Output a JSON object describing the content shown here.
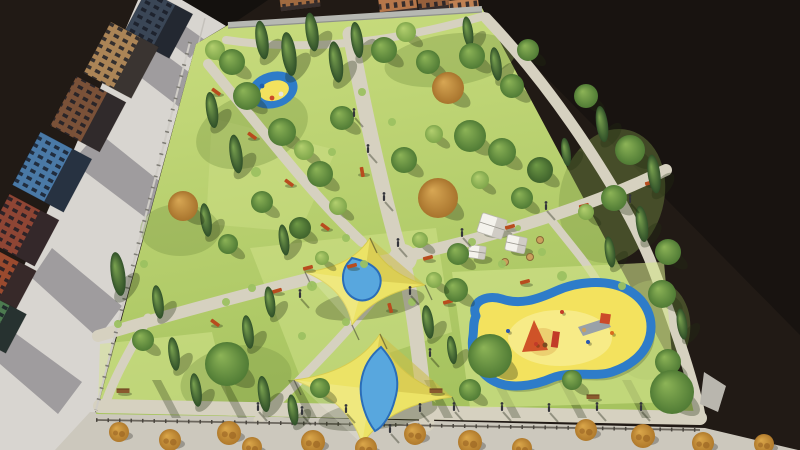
{
  "canvas": {
    "width": 800,
    "height": 450
  },
  "colors": {
    "bg": "#211a15",
    "bgDeep": "#181310",
    "street": "#d8d5d0",
    "sidewalk": "#ccc8bd",
    "curb": "#c4c1bb",
    "path": "#d6d1c0",
    "lawnTop": "#cadd7f",
    "lawnBottom": "#a6c35f",
    "lawnPatch": "#d6e690",
    "clusterShade": "#7f9c49",
    "wall": "#b6b8b2",
    "wallEdge": "#8f918c",
    "fenceLight": "#cfccc6",
    "fencePost": "#7d7b74",
    "fenceDark": "#6b665d",
    "fencePostDark": "#49453e",
    "buildingShadow": "#504e58",
    "roofDark": "#14110e",
    "windowTint": "rgba(22,26,36,0.8)",
    "sail": "#ece366",
    "sailEdge": "#d8cc4f",
    "pool": "#58a7de",
    "poolEdge": "#2a6db8",
    "playBlue": "#2e7cc9",
    "playYellow": "#f3e25e",
    "sand": "#f7ec8e",
    "pad": "#d3e48c",
    "tent": "#f4f2ec",
    "tentShade": "#c9c6be",
    "benchRed": "#b84c1e",
    "benchWood": "#8a5a2e",
    "shrubDot": "#a06a26",
    "person": "#33343a",
    "shadow": "rgba(35,48,18,0.32)",
    "stripe": "rgba(25,35,12,0.28)",
    "tree": {
      "d": [
        "#8db457",
        "#507b35"
      ],
      "k": [
        "#6f9a46",
        "#3f632c"
      ],
      "l": [
        "#b4d06f",
        "#7fa64b"
      ],
      "o": [
        "#d8a754",
        "#a8742d"
      ],
      "c": [
        "#7ba350",
        "#2f4f28"
      ],
      "s": [
        "#dba74a",
        "#b07a2c"
      ]
    },
    "bush": "#9cc161"
  },
  "scene": {
    "darkTriangle": "470,0 800,0 800,335",
    "street": "138,0 185,0 226,26 196,44 96,410 78,450 0,450 0,322",
    "sidewalk": "55,450 90,412 705,428 798,450",
    "curbLine": [
      205,
      18,
      110,
      392
    ],
    "darkWedge": "182,0 268,0 228,27",
    "streetShadows": [
      "160,8 205,40 190,58 143,22",
      "148,42 216,92 196,120 126,66",
      "98,132 168,188 146,218 72,162",
      "52,248 122,306 98,338 32,278",
      "0,322 82,382 58,414 0,364"
    ],
    "buildings": [
      {
        "cx": 158,
        "cy": 24,
        "w": 50,
        "h": 52,
        "a": -62,
        "f": "#3a4656"
      },
      {
        "cx": 121,
        "cy": 60,
        "w": 58,
        "h": 54,
        "a": -62,
        "f": "#ab8456"
      },
      {
        "cx": 88,
        "cy": 114,
        "w": 56,
        "h": 56,
        "a": -62,
        "f": "#7a5138"
      },
      {
        "cx": 52,
        "cy": 172,
        "w": 60,
        "h": 58,
        "a": -62,
        "f": "#4a79a6"
      },
      {
        "cx": 22,
        "cy": 230,
        "w": 52,
        "h": 56,
        "a": -62,
        "f": "#8e4534"
      },
      {
        "cx": 2,
        "cy": 280,
        "w": 48,
        "h": 52,
        "a": -62,
        "f": "#9a4a2e"
      },
      {
        "cx": -6,
        "cy": 322,
        "w": 44,
        "h": 50,
        "a": -62,
        "f": "#4d7a50"
      }
    ],
    "topBuildings": [
      {
        "cx": 300,
        "cy": 2,
        "w": 40,
        "h": 14,
        "a": -7,
        "f": "#a06a40"
      },
      {
        "cx": 398,
        "cy": 6,
        "w": 38,
        "h": 20,
        "a": -7,
        "f": "#b5764a"
      },
      {
        "cx": 434,
        "cy": 3,
        "w": 32,
        "h": 18,
        "a": -7,
        "f": "#96603c"
      },
      {
        "cx": 464,
        "cy": 7,
        "w": 30,
        "h": 16,
        "a": -7,
        "f": "#c08152"
      }
    ],
    "park": "196,44 230,24 482,8 704,424 96,414",
    "lawnPatches": [
      {
        "pts": "250,248 436,228 452,332 302,382",
        "o": 0.45
      },
      {
        "pts": "100,344 212,332 232,416 98,406",
        "o": 0.5
      },
      {
        "pts": "212,118 336,150 300,232 206,224",
        "o": 0.35
      }
    ],
    "clusterShades": [
      [
        252,
        130,
        58,
        36,
        -20
      ],
      [
        612,
        196,
        52,
        68,
        15
      ],
      [
        236,
        380,
        56,
        34,
        -10
      ],
      [
        450,
        60,
        66,
        26,
        -8
      ],
      [
        180,
        230,
        40,
        26,
        0
      ],
      [
        650,
        330,
        40,
        50,
        10
      ]
    ],
    "wallTop": [
      228,
      25,
      482,
      9
    ],
    "fenceLeft": [
      190,
      42,
      96,
      410
    ],
    "fenceBottom": [
      96,
      420,
      700,
      430
    ],
    "boundaryWall": "704,372 726,386 718,412 700,404",
    "paths": [
      {
        "d": "M 350,34 C 370,140 392,230 404,266 C 414,306 421,372 427,424",
        "w": 15
      },
      {
        "d": "M 98,336 C 220,300 332,272 406,256 C 470,242 580,212 666,170",
        "w": 12
      },
      {
        "d": "M 208,64 C 256,122 314,198 362,242",
        "w": 10
      },
      {
        "d": "M 486,18 C 560,96 624,198 650,260 C 672,318 694,380 700,416",
        "w": 11
      },
      {
        "d": "M 100,406 L 700,418",
        "w": 14
      },
      {
        "d": "M 398,268 C 360,320 302,380 258,420",
        "w": 9
      },
      {
        "d": "M 226,40 C 320,54 408,38 484,16",
        "w": 8
      },
      {
        "d": "M 548,216 C 570,244 588,264 600,286",
        "w": 8
      },
      {
        "d": "M 148,318 C 130,350 114,378 106,402",
        "w": 9
      }
    ],
    "plaza": [
      403,
      258,
      14
    ],
    "stripes": [
      152,
      218,
      288,
      352,
      424,
      492,
      558,
      622
    ],
    "playgroundMain": {
      "pad": "452,272 664,262 676,402 470,408",
      "blob": "M 476,316 C 470,302 486,294 502,299 C 520,305 536,300 556,291 C 576,282 606,278 628,290 C 646,300 654,318 650,336 C 646,354 630,366 612,372 C 594,378 572,370 552,378 C 534,386 508,390 492,380 C 478,372 470,352 473,336 C 474,328 473,322 476,316 Z",
      "sandEllipse": [
        560,
        338,
        52,
        28
      ],
      "sandpit": [
        543,
        342,
        16,
        14
      ],
      "equip": [
        {
          "t": "poly",
          "p": "522,352 548,350 534,320",
          "f": "#cf5328"
        },
        {
          "t": "rect",
          "x": 553,
          "y": 331,
          "w": 7,
          "h": 16,
          "a": 8,
          "f": "#c23b28"
        },
        {
          "t": "poly",
          "p": "578,327 606,318 611,327 583,336",
          "f": "#99a1a8"
        },
        {
          "t": "rect",
          "x": 601,
          "y": 313,
          "w": 10,
          "h": 10,
          "a": 8,
          "f": "#cc4a2a"
        },
        {
          "t": "dot",
          "x": 545,
          "y": 345,
          "r": 2.5,
          "f": "#7a4a20"
        },
        {
          "t": "dot",
          "x": 584,
          "y": 330,
          "r": 2.2,
          "f": "#caa05c"
        }
      ]
    },
    "playgroundSmall": {
      "cx": 273,
      "cy": 90,
      "rx": 25,
      "ry": 18,
      "a": -16,
      "irx": 15,
      "iry": 10,
      "dots": [
        [
          262,
          86,
          "#1f5fae"
        ],
        [
          281,
          94,
          "#e8e6dc"
        ],
        [
          272,
          98,
          "#cc4a2a"
        ]
      ]
    },
    "sails": [
      {
        "cx": 364,
        "cy": 280,
        "tips": [
          [
            370,
            238
          ],
          [
            425,
            285
          ],
          [
            352,
            325
          ],
          [
            305,
            272
          ]
        ],
        "mat": "M 352,258 C 370,262 384,270 380,286 C 376,300 362,304 352,297 C 341,289 341,273 347,264 Z",
        "shadow": [
          370,
          304,
          55,
          15
        ]
      },
      {
        "cx": 371,
        "cy": 389,
        "tips": [
          [
            380,
            334
          ],
          [
            452,
            397
          ],
          [
            362,
            444
          ],
          [
            294,
            380
          ]
        ],
        "mat": "M 381,347 C 395,362 401,379 395,399 C 391,415 383,427 375,431 C 367,421 359,401 361,383 C 363,367 371,355 381,347 Z",
        "shadow": [
          378,
          414,
          60,
          15
        ]
      }
    ],
    "tents": [
      [
        492,
        226,
        26,
        20,
        18
      ],
      [
        516,
        244,
        20,
        16,
        12
      ],
      [
        477,
        252,
        17,
        13,
        8
      ]
    ],
    "tables": [
      [
        463,
        259
      ],
      [
        505,
        262
      ],
      [
        530,
        257
      ],
      [
        540,
        240
      ]
    ],
    "benchesRed": [
      [
        216,
        92,
        36
      ],
      [
        252,
        136,
        36
      ],
      [
        289,
        183,
        36
      ],
      [
        325,
        227,
        36
      ],
      [
        215,
        323,
        36
      ],
      [
        277,
        291,
        -16
      ],
      [
        308,
        268,
        -15
      ],
      [
        352,
        266,
        -15
      ],
      [
        428,
        258,
        -15
      ],
      [
        510,
        227,
        -15
      ],
      [
        584,
        206,
        -15
      ],
      [
        650,
        183,
        -15
      ],
      [
        448,
        302,
        -14
      ],
      [
        525,
        282,
        -14
      ],
      [
        362,
        172,
        80
      ],
      [
        390,
        308,
        75
      ],
      [
        495,
        150,
        -40
      ]
    ],
    "benchesWood": [
      [
        123,
        391
      ],
      [
        436,
        391
      ],
      [
        593,
        397
      ],
      [
        671,
        397
      ]
    ],
    "trees": [
      [
        215,
        50,
        10,
        "l"
      ],
      [
        232,
        62,
        13,
        "d"
      ],
      [
        262,
        40,
        15,
        "c"
      ],
      [
        289,
        54,
        17,
        "c"
      ],
      [
        312,
        32,
        15,
        "c"
      ],
      [
        336,
        62,
        16,
        "c"
      ],
      [
        357,
        40,
        14,
        "c"
      ],
      [
        384,
        50,
        13,
        "d"
      ],
      [
        406,
        32,
        10,
        "l"
      ],
      [
        428,
        62,
        12,
        "d"
      ],
      [
        448,
        88,
        16,
        "o"
      ],
      [
        468,
        32,
        12,
        "c"
      ],
      [
        472,
        56,
        13,
        "d"
      ],
      [
        496,
        64,
        13,
        "c"
      ],
      [
        512,
        86,
        12,
        "d"
      ],
      [
        528,
        50,
        11,
        "d"
      ],
      [
        247,
        96,
        14,
        "d"
      ],
      [
        212,
        110,
        14,
        "c"
      ],
      [
        282,
        132,
        14,
        "d"
      ],
      [
        236,
        154,
        15,
        "c"
      ],
      [
        304,
        150,
        10,
        "l"
      ],
      [
        320,
        174,
        13,
        "d"
      ],
      [
        206,
        220,
        13,
        "c"
      ],
      [
        183,
        206,
        15,
        "o"
      ],
      [
        262,
        202,
        11,
        "d"
      ],
      [
        300,
        228,
        11,
        "k"
      ],
      [
        338,
        206,
        9,
        "l"
      ],
      [
        284,
        240,
        12,
        "c"
      ],
      [
        228,
        244,
        10,
        "d"
      ],
      [
        118,
        274,
        17,
        "c"
      ],
      [
        158,
        302,
        13,
        "c"
      ],
      [
        143,
        340,
        11,
        "d"
      ],
      [
        174,
        354,
        13,
        "c"
      ],
      [
        342,
        118,
        12,
        "d"
      ],
      [
        404,
        160,
        13,
        "d"
      ],
      [
        438,
        198,
        20,
        "o"
      ],
      [
        470,
        136,
        16,
        "d"
      ],
      [
        434,
        134,
        9,
        "l"
      ],
      [
        502,
        152,
        14,
        "d"
      ],
      [
        540,
        170,
        13,
        "k"
      ],
      [
        566,
        152,
        11,
        "c"
      ],
      [
        480,
        180,
        9,
        "l"
      ],
      [
        522,
        198,
        11,
        "d"
      ],
      [
        420,
        240,
        8,
        "l"
      ],
      [
        458,
        254,
        11,
        "d"
      ],
      [
        586,
        96,
        12,
        "d"
      ],
      [
        602,
        124,
        14,
        "c"
      ],
      [
        630,
        150,
        15,
        "d"
      ],
      [
        654,
        174,
        15,
        "c"
      ],
      [
        614,
        198,
        13,
        "d"
      ],
      [
        642,
        224,
        14,
        "c"
      ],
      [
        610,
        252,
        12,
        "c"
      ],
      [
        668,
        252,
        13,
        "d"
      ],
      [
        586,
        212,
        8,
        "l"
      ],
      [
        270,
        302,
        12,
        "c"
      ],
      [
        248,
        332,
        13,
        "c"
      ],
      [
        227,
        364,
        22,
        "d"
      ],
      [
        196,
        390,
        13,
        "c"
      ],
      [
        264,
        394,
        14,
        "c"
      ],
      [
        293,
        410,
        12,
        "c"
      ],
      [
        320,
        388,
        10,
        "d"
      ],
      [
        428,
        322,
        13,
        "c"
      ],
      [
        452,
        350,
        11,
        "c"
      ],
      [
        322,
        258,
        7,
        "l"
      ],
      [
        456,
        290,
        12,
        "d"
      ],
      [
        434,
        280,
        8,
        "l"
      ],
      [
        490,
        356,
        22,
        "d"
      ],
      [
        662,
        294,
        14,
        "d"
      ],
      [
        682,
        324,
        12,
        "c"
      ],
      [
        668,
        362,
        13,
        "d"
      ],
      [
        672,
        392,
        22,
        "d"
      ],
      [
        572,
        380,
        10,
        "d"
      ],
      [
        470,
        390,
        11,
        "d"
      ]
    ],
    "bushes": [
      [
        256,
        172,
        5
      ],
      [
        346,
        238,
        4
      ],
      [
        312,
        286,
        5
      ],
      [
        364,
        264,
        4
      ],
      [
        252,
        288,
        4
      ],
      [
        226,
        302,
        4
      ],
      [
        412,
        302,
        4
      ],
      [
        302,
        336,
        4
      ],
      [
        346,
        322,
        4
      ],
      [
        472,
        242,
        4
      ],
      [
        502,
        264,
        4
      ],
      [
        542,
        252,
        4
      ],
      [
        332,
        152,
        4
      ],
      [
        362,
        92,
        4
      ],
      [
        392,
        122,
        4
      ],
      [
        562,
        276,
        5
      ],
      [
        622,
        286,
        4
      ],
      [
        118,
        324,
        4
      ],
      [
        144,
        264,
        4
      ],
      [
        518,
        228,
        3
      ]
    ],
    "shrubs": [
      [
        119,
        432,
        10
      ],
      [
        170,
        440,
        11
      ],
      [
        229,
        433,
        12
      ],
      [
        252,
        447,
        10
      ],
      [
        313,
        442,
        12
      ],
      [
        366,
        448,
        11
      ],
      [
        415,
        434,
        11
      ],
      [
        470,
        442,
        12
      ],
      [
        522,
        448,
        10
      ],
      [
        586,
        430,
        11
      ],
      [
        643,
        436,
        12
      ],
      [
        703,
        443,
        11
      ],
      [
        764,
        444,
        10
      ]
    ],
    "people": [
      [
        368,
        150
      ],
      [
        384,
        198
      ],
      [
        398,
        244
      ],
      [
        410,
        292
      ],
      [
        354,
        114
      ],
      [
        462,
        234
      ],
      [
        546,
        207
      ],
      [
        302,
        412
      ],
      [
        346,
        410
      ],
      [
        420,
        409
      ],
      [
        454,
        408
      ],
      [
        502,
        408
      ],
      [
        549,
        409
      ],
      [
        597,
        408
      ],
      [
        641,
        408
      ],
      [
        430,
        354
      ],
      [
        258,
        408
      ],
      [
        630,
        200
      ],
      [
        300,
        295
      ],
      [
        390,
        430
      ]
    ],
    "kids": [
      [
        562,
        312,
        "#c23b28"
      ],
      [
        588,
        342,
        "#2a58b0"
      ],
      [
        612,
        333,
        "#d96c1e"
      ],
      [
        536,
        344,
        "#c23b28"
      ],
      [
        508,
        331,
        "#2a58b0"
      ]
    ]
  }
}
